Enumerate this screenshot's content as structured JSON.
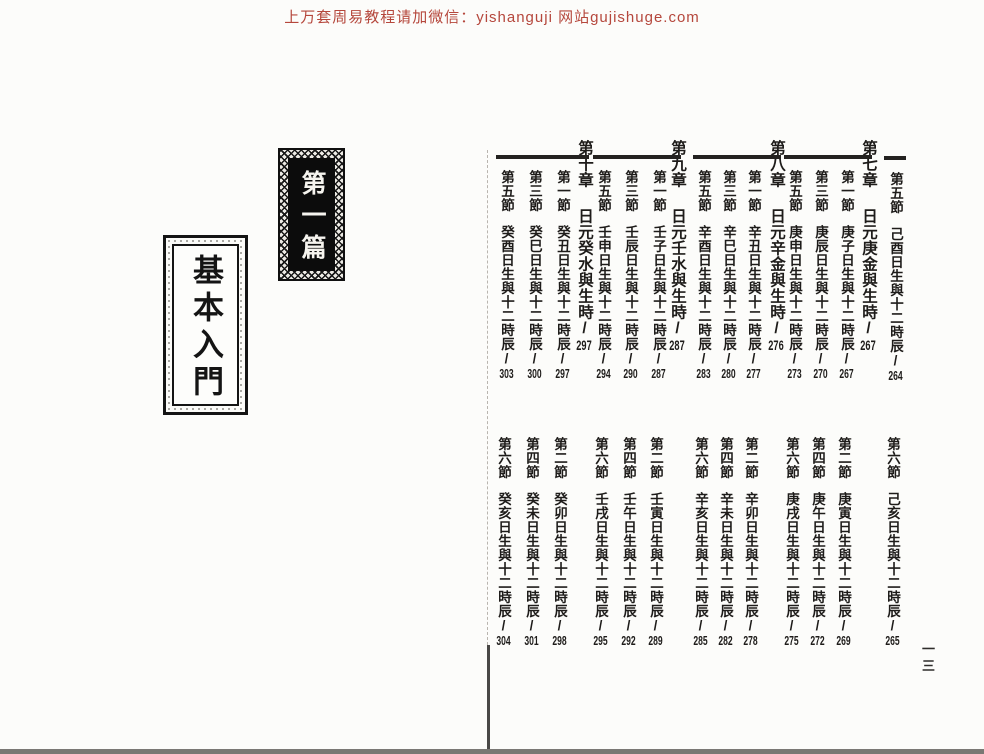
{
  "header": {
    "promo_text": "上万套周易教程请加微信：yishanguji 网站gujishuge.com"
  },
  "left_page": {
    "part_label": "第一篇",
    "part_title": "基本入門"
  },
  "right_page": {
    "folio": "一三",
    "carryover_previous_chapter": {
      "odd_section": {
        "label": "第五節",
        "title": "己酉日生與十二時辰",
        "page": "264"
      },
      "even_section": {
        "label": "第六節",
        "title": "己亥日生與十二時辰",
        "page": "265"
      }
    },
    "chapters": [
      {
        "label": "第七章",
        "title": "日元庚金與生時",
        "page": "267",
        "odd_sections": [
          {
            "label": "第一節",
            "title": "庚子日生與十二時辰",
            "page": "267"
          },
          {
            "label": "第三節",
            "title": "庚辰日生與十二時辰",
            "page": "270"
          },
          {
            "label": "第五節",
            "title": "庚申日生與十二時辰",
            "page": "273"
          }
        ],
        "even_sections": [
          {
            "label": "第二節",
            "title": "庚寅日生與十二時辰",
            "page": "269"
          },
          {
            "label": "第四節",
            "title": "庚午日生與十二時辰",
            "page": "272"
          },
          {
            "label": "第六節",
            "title": "庚戌日生與十二時辰",
            "page": "275"
          }
        ]
      },
      {
        "label": "第八章",
        "title": "日元辛金與生時",
        "page": "276",
        "odd_sections": [
          {
            "label": "第一節",
            "title": "辛丑日生與十二時辰",
            "page": "277"
          },
          {
            "label": "第三節",
            "title": "辛巳日生與十二時辰",
            "page": "280"
          },
          {
            "label": "第五節",
            "title": "辛酉日生與十二時辰",
            "page": "283"
          }
        ],
        "even_sections": [
          {
            "label": "第二節",
            "title": "辛卯日生與十二時辰",
            "page": "278"
          },
          {
            "label": "第四節",
            "title": "辛未日生與十二時辰",
            "page": "282"
          },
          {
            "label": "第六節",
            "title": "辛亥日生與十二時辰",
            "page": "285"
          }
        ]
      },
      {
        "label": "第九章",
        "title": "日元壬水與生時",
        "page": "287",
        "odd_sections": [
          {
            "label": "第一節",
            "title": "壬子日生與十二時辰",
            "page": "287"
          },
          {
            "label": "第三節",
            "title": "壬辰日生與十二時辰",
            "page": "290"
          },
          {
            "label": "第五節",
            "title": "壬申日生與十二時辰",
            "page": "294"
          }
        ],
        "even_sections": [
          {
            "label": "第二節",
            "title": "壬寅日生與十二時辰",
            "page": "289"
          },
          {
            "label": "第四節",
            "title": "壬午日生與十二時辰",
            "page": "292"
          },
          {
            "label": "第六節",
            "title": "壬戌日生與十二時辰",
            "page": "295"
          }
        ]
      },
      {
        "label": "第十章",
        "title": "日元癸水與生時",
        "page": "297",
        "odd_sections": [
          {
            "label": "第一節",
            "title": "癸丑日生與十二時辰",
            "page": "297"
          },
          {
            "label": "第三節",
            "title": "癸巳日生與十二時辰",
            "page": "300"
          },
          {
            "label": "第五節",
            "title": "癸酉日生與十二時辰",
            "page": "303"
          }
        ],
        "even_sections": [
          {
            "label": "第二節",
            "title": "癸卯日生與十二時辰",
            "page": "298"
          },
          {
            "label": "第四節",
            "title": "癸未日生與十二時辰",
            "page": "301"
          },
          {
            "label": "第六節",
            "title": "癸亥日生與十二時辰",
            "page": "304"
          }
        ]
      }
    ]
  },
  "colors": {
    "ink": "#1e1c1a",
    "promo_red": "#b5473c"
  }
}
